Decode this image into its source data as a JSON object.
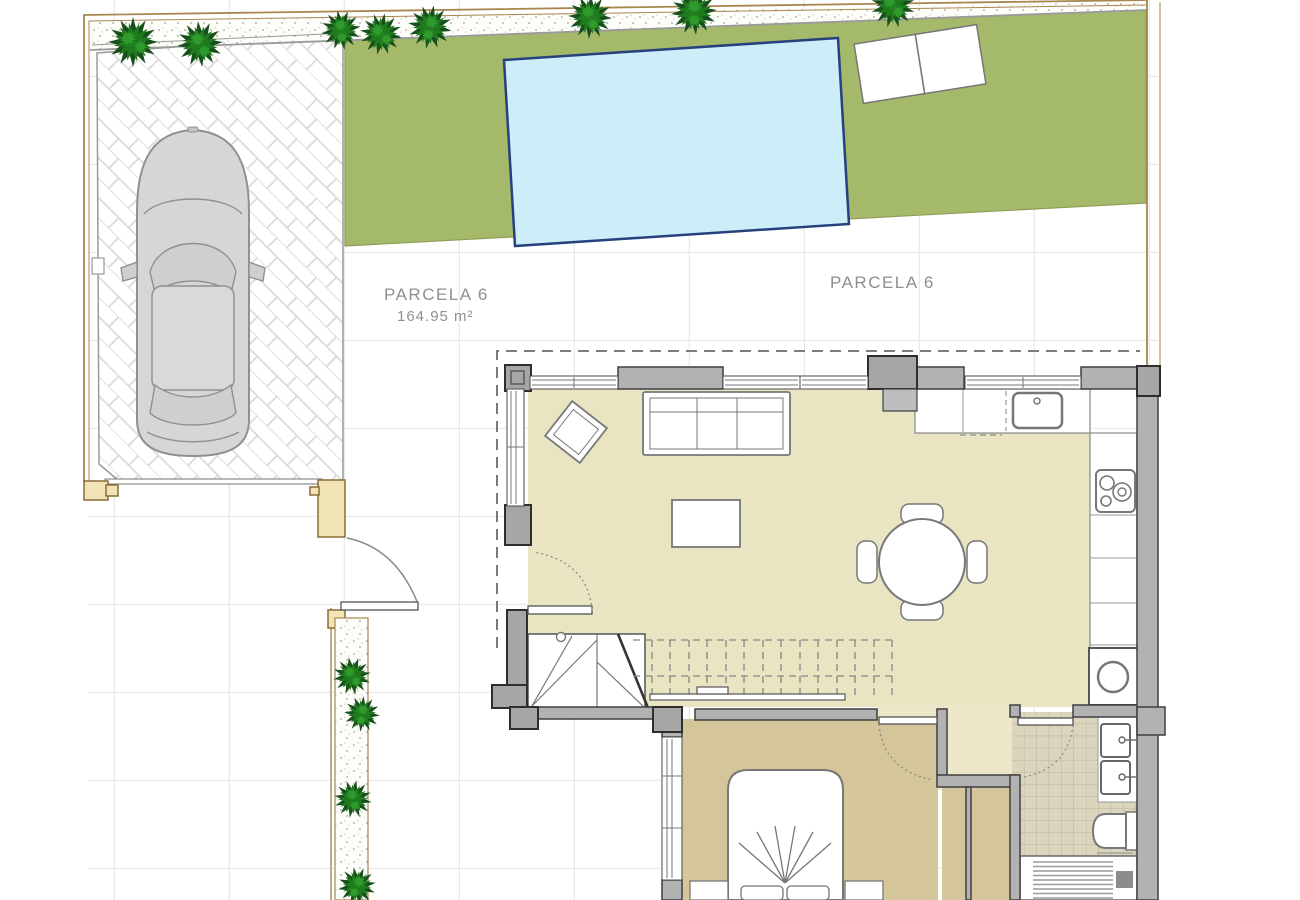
{
  "plan": {
    "labels": {
      "parcela_left": {
        "title": "PARCELA 6",
        "area": "164.95 m²"
      },
      "parcela_right": {
        "title": "PARCELA 6"
      }
    },
    "colors": {
      "grass": "#a5b96b",
      "pool_water": "#cdeef9",
      "pool_border": "#27417e",
      "living_floor": "#e9e4c2",
      "bedroom_floor": "#d5c59b",
      "corridor_floor": "#ece7c9",
      "bathroom_tile": "#dbd5be",
      "wall": "#b2b2b2",
      "pillar": "#a6a6a6",
      "plot_wall_fill": "#f1e5b8",
      "boundary_line": "#a8874f",
      "label_text": "#8f8f8f",
      "car_body": "#d6d6d6",
      "tree_dark": "#17501a",
      "tree_light": "#1f7a1e",
      "paving_grid": "#eaeaea"
    }
  }
}
